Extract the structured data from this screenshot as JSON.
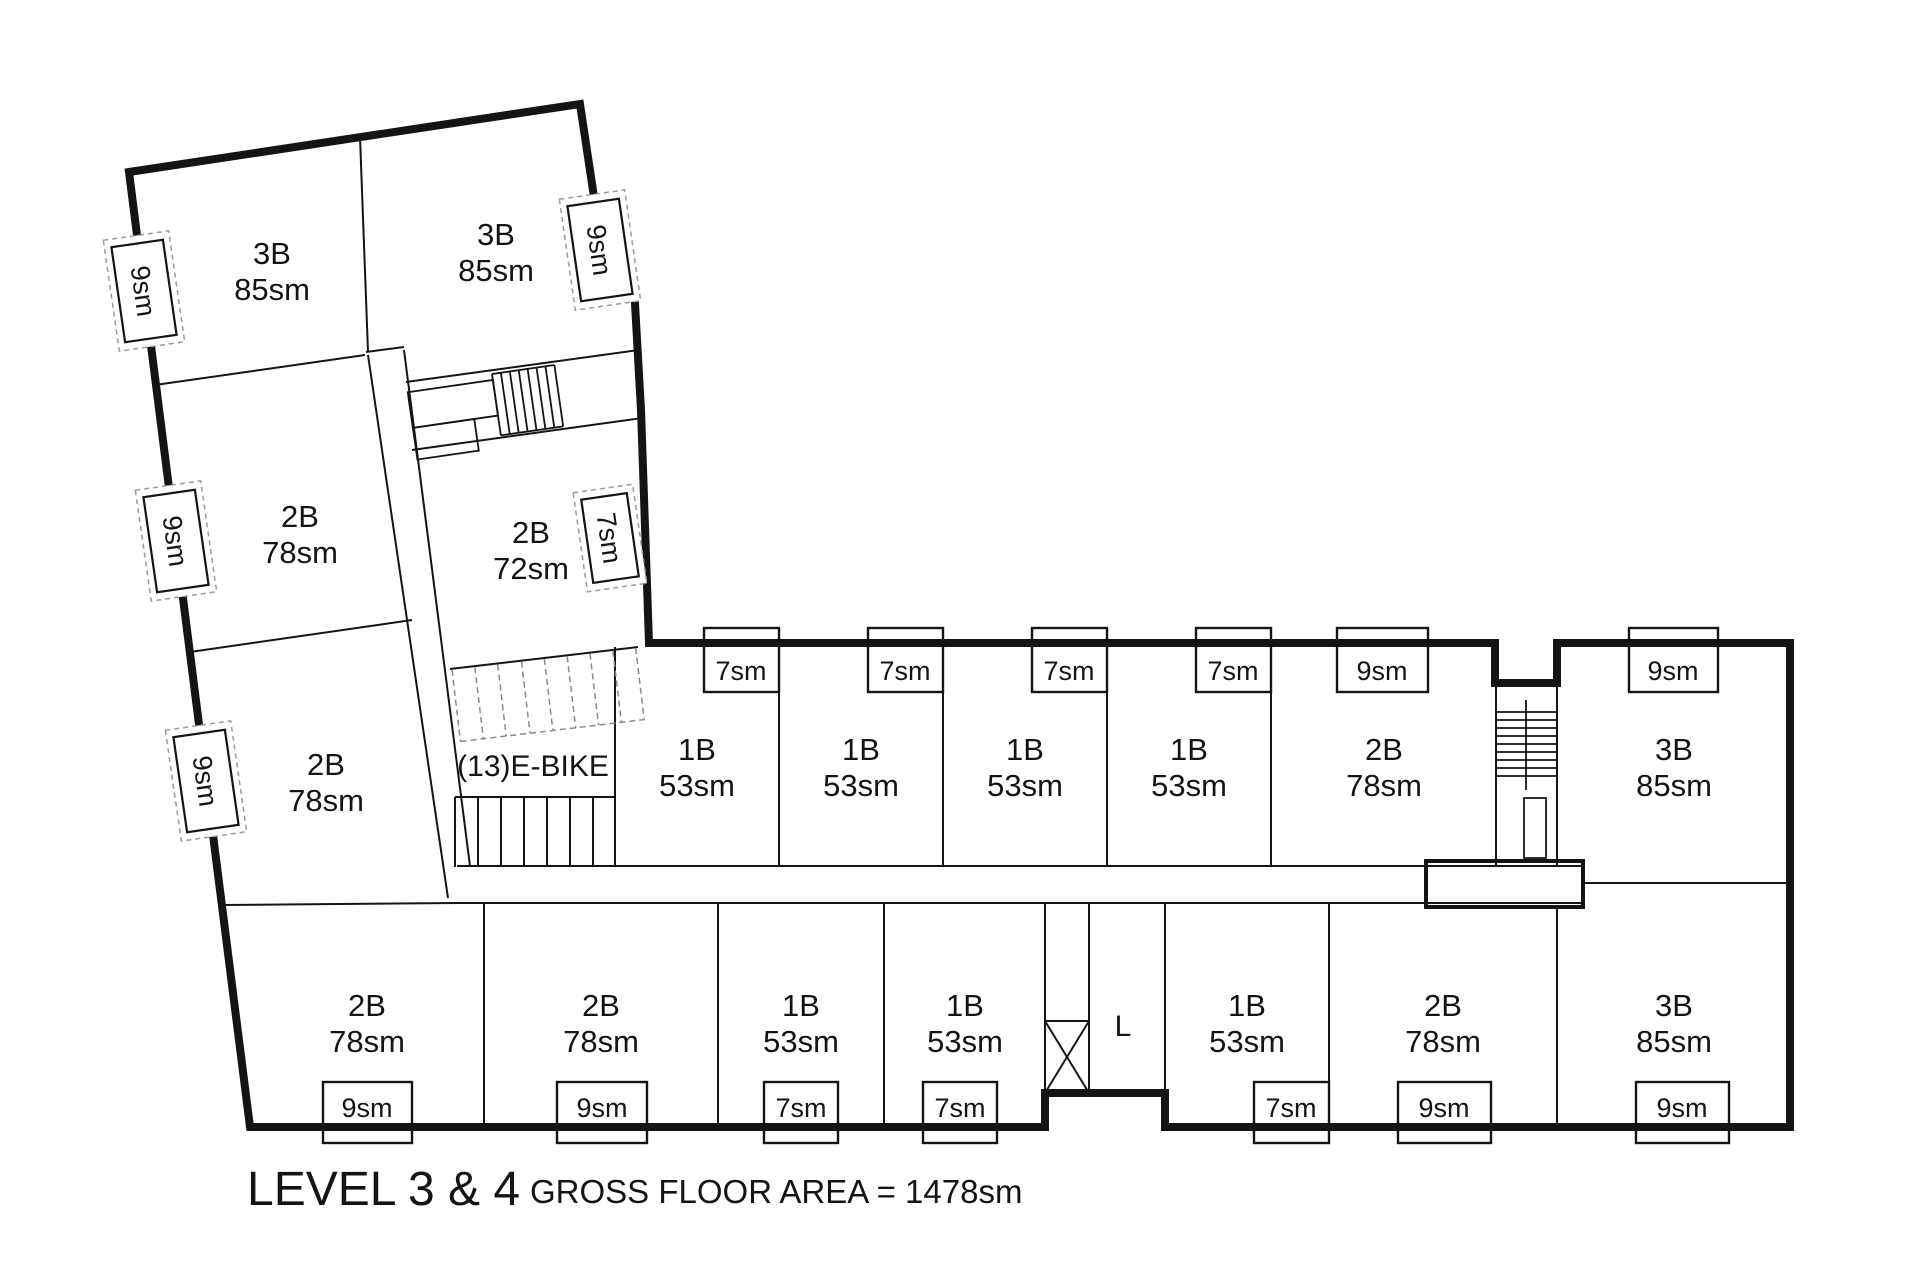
{
  "plan_title": {
    "main": "LEVEL 3 & 4",
    "sub": "GROSS FLOOR AREA = 1478sm"
  },
  "units": {
    "w1": {
      "type": "3B",
      "area": "85sm"
    },
    "w2": {
      "type": "3B",
      "area": "85sm"
    },
    "w3": {
      "type": "2B",
      "area": "78sm"
    },
    "w4": {
      "type": "2B",
      "area": "72sm"
    },
    "w5": {
      "type": "2B",
      "area": "78sm"
    },
    "m1": {
      "type": "1B",
      "area": "53sm"
    },
    "m2": {
      "type": "1B",
      "area": "53sm"
    },
    "m3": {
      "type": "1B",
      "area": "53sm"
    },
    "m4": {
      "type": "1B",
      "area": "53sm"
    },
    "m5": {
      "type": "2B",
      "area": "78sm"
    },
    "m6": {
      "type": "3B",
      "area": "85sm"
    },
    "b1": {
      "type": "2B",
      "area": "78sm"
    },
    "b2": {
      "type": "2B",
      "area": "78sm"
    },
    "b3": {
      "type": "1B",
      "area": "53sm"
    },
    "b4": {
      "type": "1B",
      "area": "53sm"
    },
    "b5": {
      "type": "1B",
      "area": "53sm"
    },
    "b6": {
      "type": "2B",
      "area": "78sm"
    },
    "b7": {
      "type": "3B",
      "area": "85sm"
    }
  },
  "features": {
    "ebike_label": "(13)E-BIKE",
    "elevator_label": "L"
  },
  "balconies": {
    "wl1": "9sm",
    "wl2": "9sm",
    "wl3": "9sm",
    "wr1": "9sm",
    "wr2": "7sm",
    "t1": "7sm",
    "t2": "7sm",
    "t3": "7sm",
    "t4": "7sm",
    "t5": "9sm",
    "t6": "9sm",
    "bt1": "9sm",
    "bt2": "9sm",
    "bt3": "7sm",
    "bt4": "7sm",
    "bt5": "7sm",
    "bt6": "9sm",
    "bt7": "9sm"
  }
}
